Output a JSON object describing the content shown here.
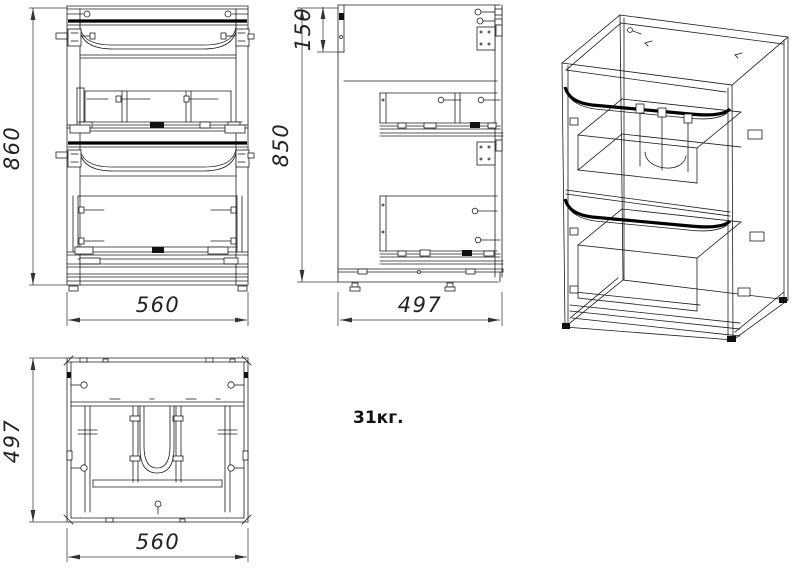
{
  "dims": {
    "front_height": "860",
    "front_width": "560",
    "side_height": "850",
    "side_top": "150",
    "side_depth": "497",
    "top_depth": "497",
    "top_width": "560"
  },
  "weight_label": "31кг.",
  "colors": {
    "line": "#1d1d1d",
    "dim": "#3a3a3a",
    "background": "#ffffff"
  }
}
